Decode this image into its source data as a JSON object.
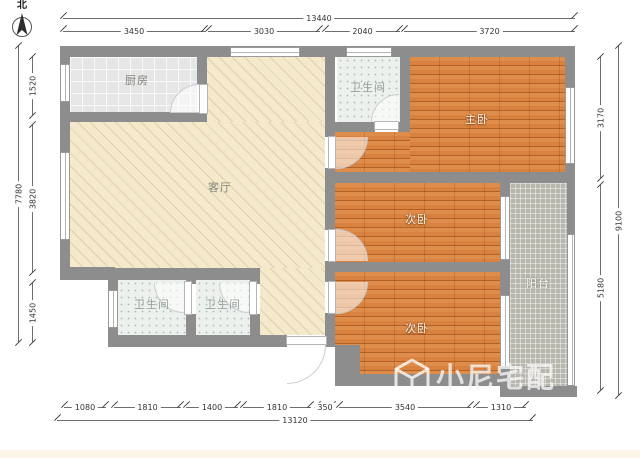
{
  "plan": {
    "north_label": "北",
    "watermark_text": "小尼宅配",
    "rooms": {
      "kitchen": "厨房",
      "living": "客厅",
      "bath_top": "卫生间",
      "master": "主卧",
      "bed_mid": "次卧",
      "bed_bottom": "次卧",
      "bath_left": "卫生间",
      "bath_right": "卫生间",
      "balcony": "阳台"
    },
    "dims": {
      "top_total": "13440",
      "top": [
        "3450",
        "3030",
        "2040",
        "3720"
      ],
      "left_total": "7780",
      "left": [
        "1520",
        "3820",
        "1450"
      ],
      "right_total": "9100",
      "right": [
        "3170",
        "5180"
      ],
      "bottom_total": "13120",
      "bottom": [
        "1080",
        "1810",
        "1400",
        "1810",
        "350",
        "3540",
        "1310"
      ]
    },
    "colors": {
      "wall": "#8d8d8d",
      "living_floor": "#f4eacb",
      "wood_floor": "#d9813f",
      "bath_floor": "#edf1ee",
      "kitchen_floor": "#e6e6e6",
      "balcony_floor": "#b9b6ad"
    }
  }
}
